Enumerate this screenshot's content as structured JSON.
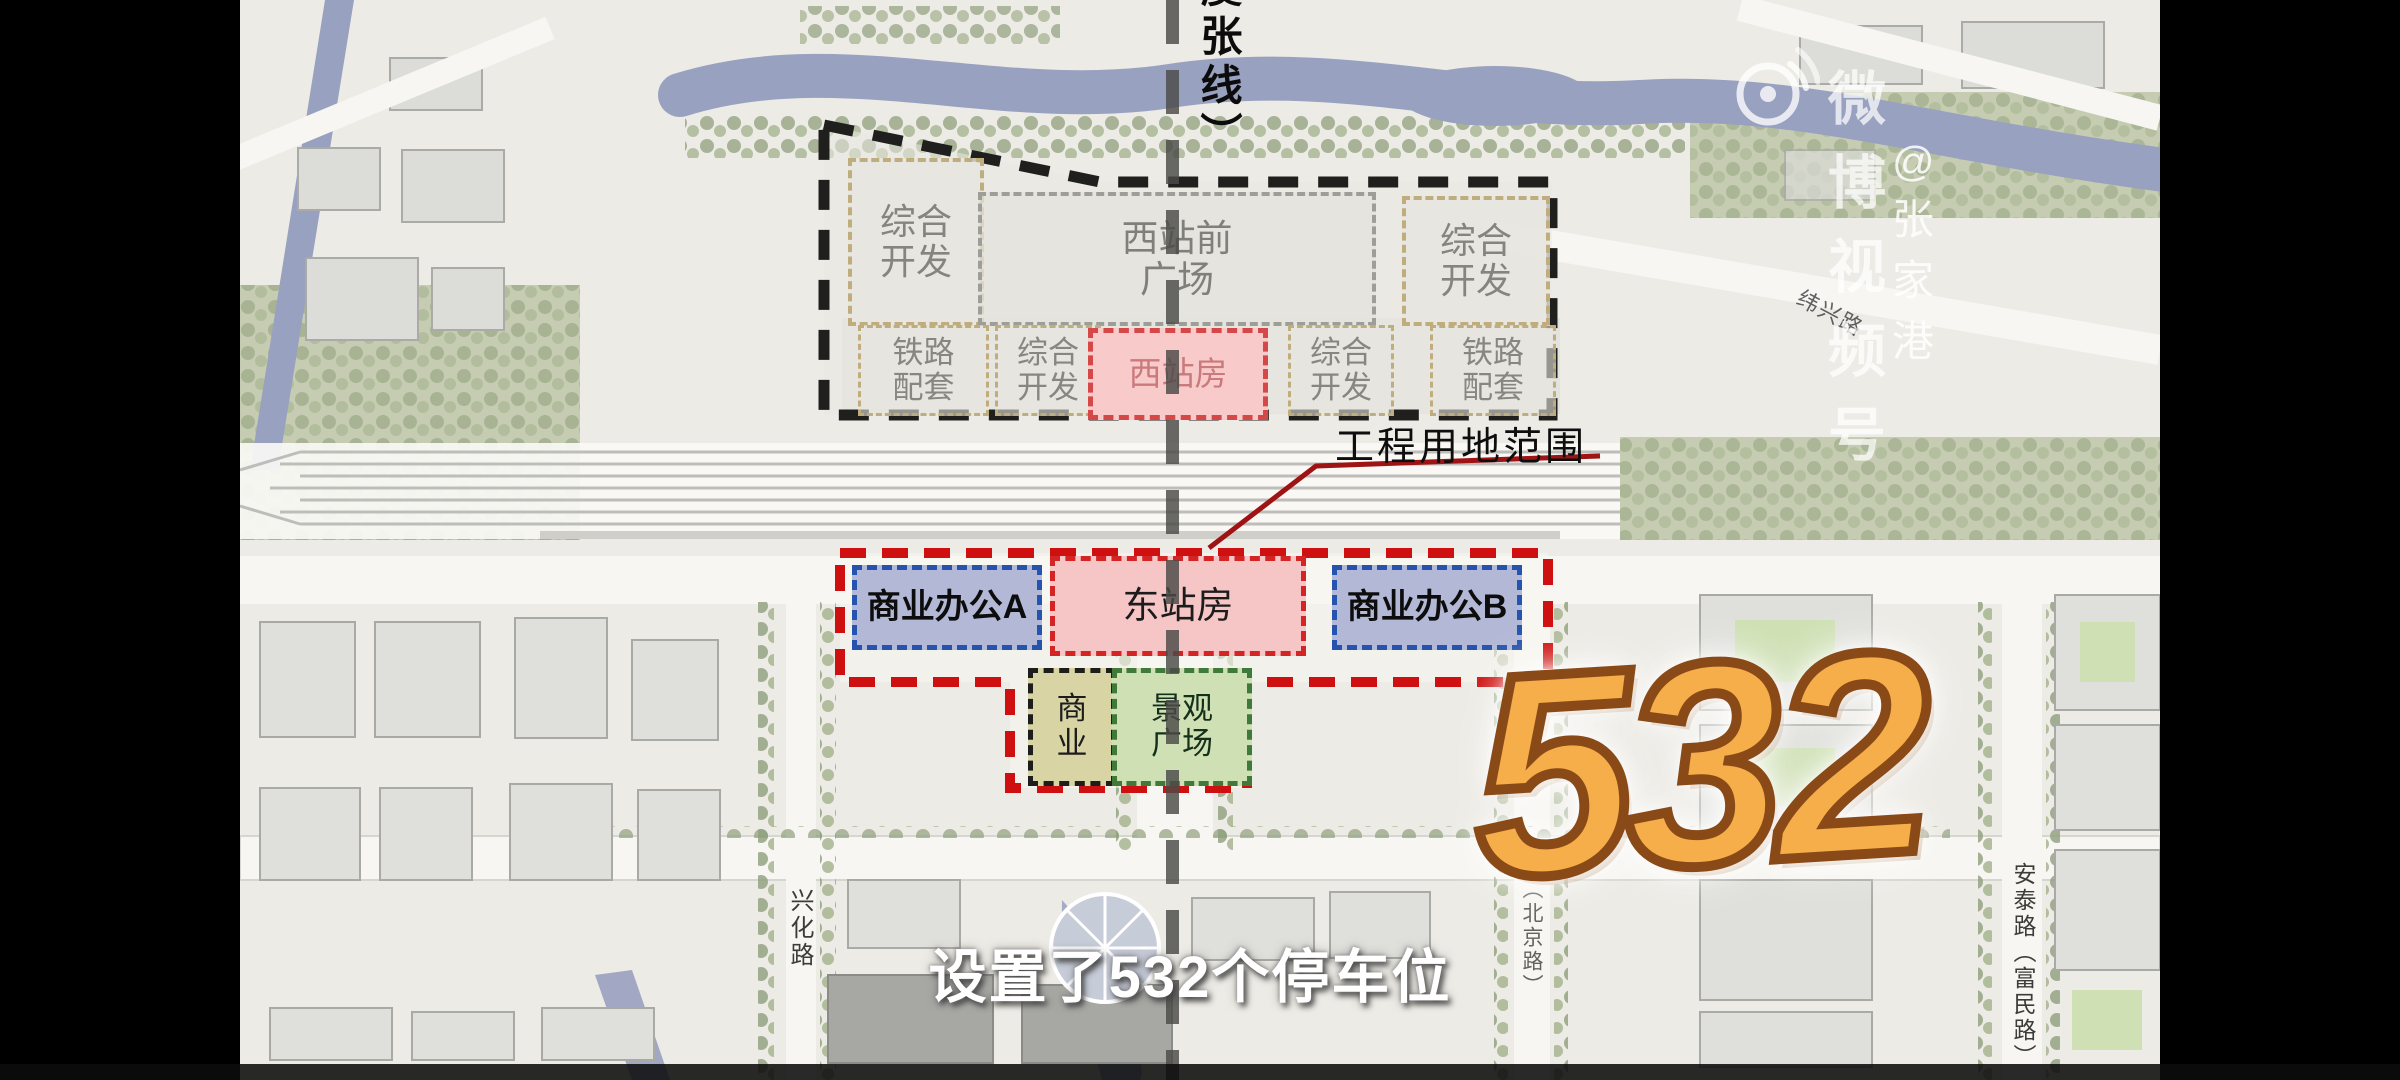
{
  "watermark": {
    "brand": "微博视频号",
    "handle": "@张家港",
    "icon": "weibo-video-eye-icon"
  },
  "top_label": {
    "text": "（虞张线）"
  },
  "callout": {
    "text": "工程用地范围"
  },
  "zones": {
    "dev_top_left": "综合\n开发",
    "west_plaza": "西站前\n广场",
    "dev_top_right": "综合\n开发",
    "rail_left": "铁路\n配套",
    "dev_mid_left": "综合\n开发",
    "west_station": "西站房",
    "dev_mid_right": "综合\n开发",
    "rail_right": "铁路\n配套",
    "office_a": "商业办公A",
    "east_station": "东站房",
    "office_b": "商业办公B",
    "commerce": "商\n业",
    "landscape": "景观\n广场"
  },
  "roads": {
    "xinghua": "兴化路",
    "antai": "安泰路（富民路）",
    "weixing": "纬兴路",
    "beijing": "（北京路）"
  },
  "overlay": {
    "number": "532",
    "subtitle": "设置了532个停车位"
  },
  "colors": {
    "project_boundary_red": "#cf1010",
    "station_boundary_black": "#1f1f1d",
    "office_blue": "#2553ad",
    "landscape_green": "#3f7a38",
    "number_orange": "#f6ae4a",
    "river_blue": "#99a1c0"
  }
}
